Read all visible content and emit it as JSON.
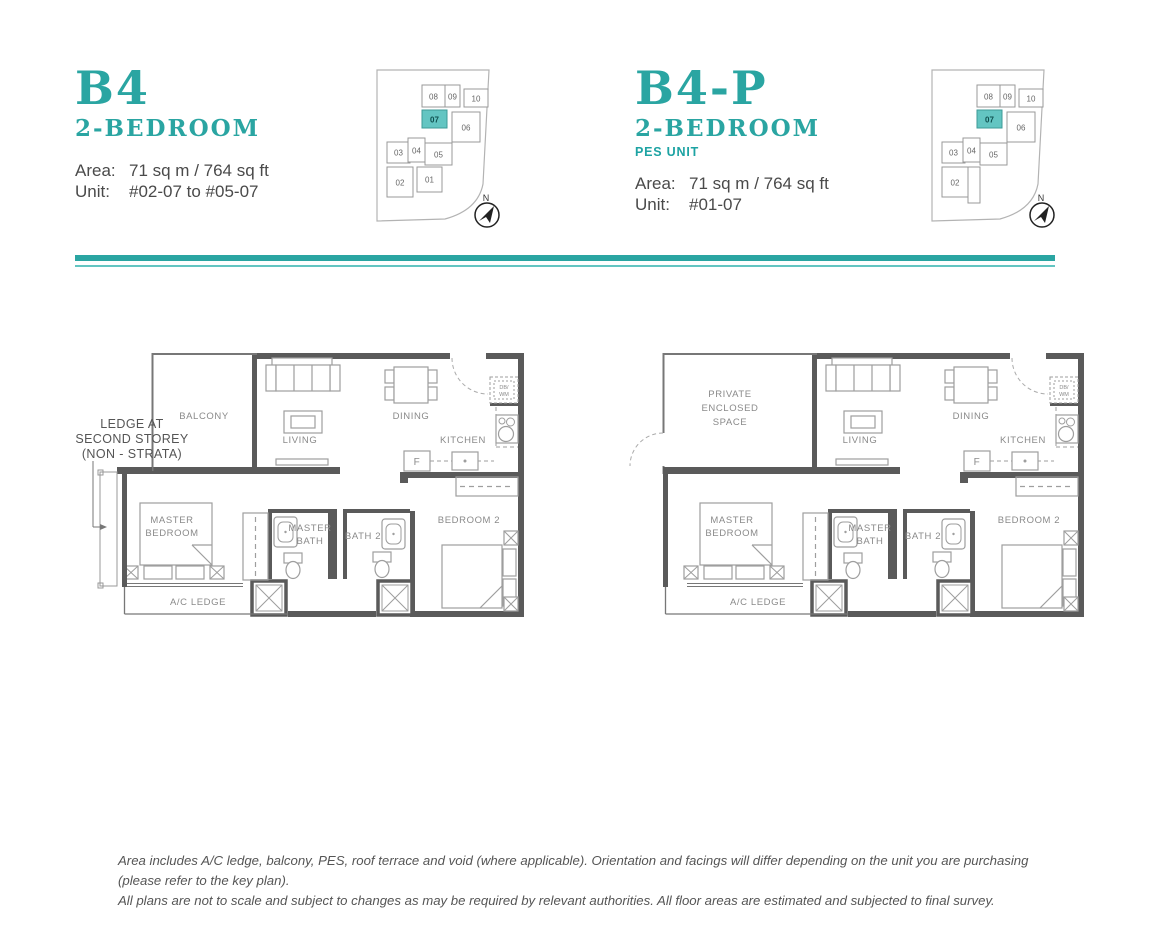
{
  "palette": {
    "accent_teal": "#2aa5a2",
    "keyplan_highlight": "#63c5c2",
    "wall_gray": "#5a5a5a",
    "furniture_gray": "#9e9e9e",
    "label_gray": "#8a8a8a"
  },
  "units": [
    {
      "code": "B4",
      "type": "2-BEDROOM",
      "area_label": "Area:",
      "area_value": "71 sq m / 764 sq ft",
      "unit_label": "Unit:",
      "unit_value": "#02-07 to #05-07",
      "outdoor_room": "BALCONY",
      "ledge_note": {
        "l1": "LEDGE AT",
        "l2": "SECOND STOREY",
        "l3": "(NON - STRATA)"
      }
    },
    {
      "code": "B4-P",
      "type": "2-BEDROOM",
      "pes_label": "PES UNIT",
      "area_label": "Area:",
      "area_value": "71 sq m / 764 sq ft",
      "unit_label": "Unit:",
      "unit_value": "#01-07",
      "outdoor": {
        "l1": "PRIVATE",
        "l2": "ENCLOSED",
        "l3": "SPACE"
      }
    }
  ],
  "rooms": {
    "living": "LIVING",
    "dining": "DINING",
    "kitchen": "KITCHEN",
    "fridge": "F",
    "db": "DB/",
    "wm": "WM",
    "master_bedroom_l1": "MASTER",
    "master_bedroom_l2": "BEDROOM",
    "master_bath_l1": "MASTER",
    "master_bath_l2": "BATH",
    "bath2": "BATH 2",
    "bedroom2": "BEDROOM 2",
    "ac_ledge": "A/C LEDGE"
  },
  "keyplan": {
    "north": "N",
    "highlighted": "07",
    "units": {
      "u01": "01",
      "u02": "02",
      "u03": "03",
      "u04": "04",
      "u05": "05",
      "u06": "06",
      "u07": "07",
      "u08": "08",
      "u09": "09",
      "u10": "10"
    }
  },
  "footer": {
    "line1": "Area includes A/C ledge, balcony, PES, roof terrace and void (where applicable). Orientation and facings will differ depending on the unit you are purchasing (please refer to the key plan).",
    "line2": "All plans are not to scale and subject to changes as may be required by relevant authorities. All floor areas are estimated and subjected to final survey."
  }
}
